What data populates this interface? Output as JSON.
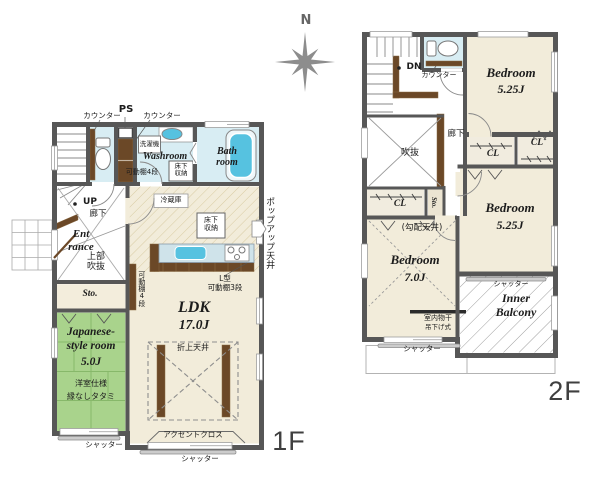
{
  "compass": {
    "north": "N"
  },
  "colors": {
    "wall": "#575757",
    "floor_cream": "#f2ecda",
    "water_blue": "#d8edf3",
    "tatami_green": "#a9d38c",
    "wood_brown": "#6b4827",
    "fixture_blue": "#56c2e0",
    "hatch_kitchen": "#d8cba2",
    "hatch_balcony": "#9f9f9f"
  },
  "floor1": {
    "label": "1F",
    "rooms": {
      "ldk_name": "LDK",
      "ldk_size": "17.0J",
      "jp_line1": "Japanese-",
      "jp_line2": "style room",
      "jp_size": "5.0J",
      "jp_note1": "洋室仕様",
      "jp_note2": "縁なしタタミ",
      "washroom": "Washroom",
      "bath_line1": "Bath",
      "bath_line2": "room",
      "ent_line1": "Ent",
      "ent_line2": "rance",
      "storage": "Sto."
    },
    "ann": {
      "counter_toilet": "カウンター",
      "ps": "PS",
      "counter_wash": "カウンター",
      "washing_machine": "洗濯機",
      "underfloor_wash": "床下収納",
      "shelf4_top": "可動棚4段",
      "up": "UP",
      "hallway": "廊下",
      "upper_void": "上部吹抜",
      "refrigerator": "冷蔵庫",
      "underfloor_kitchen": "床下収納",
      "popup_ceiling": "ポップアップ天井",
      "l_shelf_1": "L型",
      "l_shelf_2": "可動棚3段",
      "shelf4_wall": "可動棚4段",
      "coffered_ceiling": "折上天井",
      "accent_cloth": "アクセントクロス",
      "shutter_ldk": "シャッター",
      "shutter_jp": "シャッター"
    }
  },
  "floor2": {
    "label": "2F",
    "rooms": {
      "bedroom_a_name": "Bedroom",
      "bedroom_a_size": "5.25J",
      "bedroom_b_name": "Bedroom",
      "bedroom_b_size": "5.25J",
      "bedroom_c_name": "Bedroom",
      "bedroom_c_size": "7.0J",
      "balcony_line1": "Inner",
      "balcony_line2": "Balcony",
      "storage": "Sto.",
      "cl_hall": "CL",
      "cl_mid": "CL",
      "cl_right": "CL"
    },
    "ann": {
      "dn": "DN",
      "counter": "カウンター",
      "hallway": "廊下",
      "void": "吹抜",
      "sloped_ceiling": "(勾配天井)",
      "indoor_drying": "室内物干",
      "hanging_type": "吊下げ式",
      "shutter_bedroom": "シャッター",
      "shutter_balcony": "シャッター"
    }
  }
}
